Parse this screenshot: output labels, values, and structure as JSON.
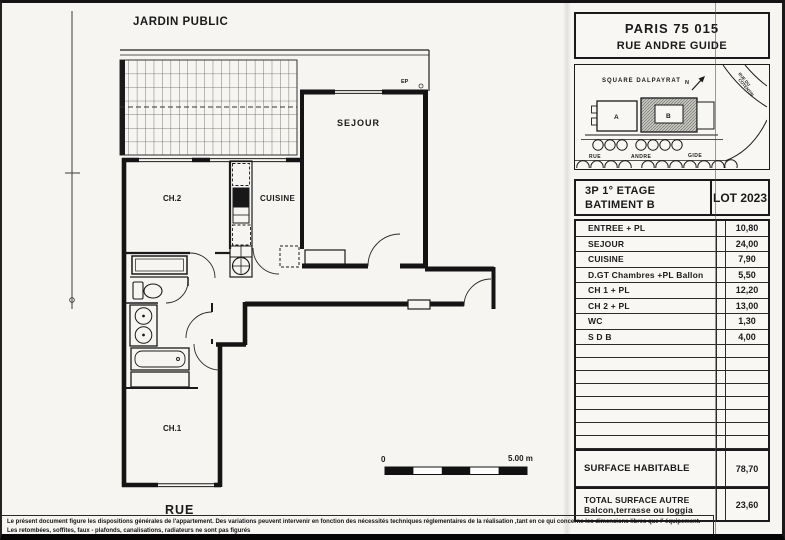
{
  "plan": {
    "labels": {
      "jardin": "JARDIN PUBLIC",
      "sejour": "SEJOUR",
      "ch2": "CH.2",
      "cuisine": "CUISINE",
      "ch1": "CH.1",
      "rue": "RUE",
      "ep": "EP"
    },
    "scale_bar": {
      "start": "0",
      "end": "5.00 m"
    }
  },
  "title_block": {
    "city": "PARIS  75 015",
    "street": "RUE ANDRE GUIDE",
    "map": {
      "square": "SQUARE   DALPAYRAT",
      "north": "N",
      "building_a": "A",
      "building_b": "B",
      "street_rue": "RUE",
      "street_andre": "ANDRE",
      "street_gide": "GIDE",
      "street_diag_1": "RUE DU",
      "street_diag_2": "COTENTIN"
    },
    "lot": {
      "line1": "3P 1° ETAGE",
      "line2": "BATIMENT B",
      "lot": "LOT 2023"
    },
    "rooms": [
      {
        "label": "ENTREE  + PL",
        "value": "10,80"
      },
      {
        "label": "SEJOUR",
        "value": "24,00"
      },
      {
        "label": "CUISINE",
        "value": "7,90"
      },
      {
        "label": "D.GT Chambres +PL Ballon",
        "value": "5,50"
      },
      {
        "label": "CH 1 + PL",
        "value": "12,20"
      },
      {
        "label": "CH 2 + PL",
        "value": "13,00"
      },
      {
        "label": "WC",
        "value": "1,30"
      },
      {
        "label": "S D B",
        "value": "4,00"
      }
    ],
    "surface": {
      "label": "SURFACE HABITABLE",
      "value": "78,70"
    },
    "total": {
      "label1": "TOTAL SURFACE AUTRE",
      "label2": "Balcon,terrasse ou loggia",
      "value": "23,60"
    }
  },
  "footer": {
    "line1": "Le présent document figure les dispositions générales de l'appartement. Des variations peuvent intervenir en fonction des nécessités techniques réglementaires de la réalisation ,tant en ce qui concerne les dimensions libres que l' équipement.",
    "line2": "Les retombées, soffites, faux - plafonds, canalisations, radiateurs ne sont pas  figurés"
  },
  "colors": {
    "ink": "#1a1a1a",
    "paper": "#f6f5f1",
    "appliance": "#181818"
  }
}
